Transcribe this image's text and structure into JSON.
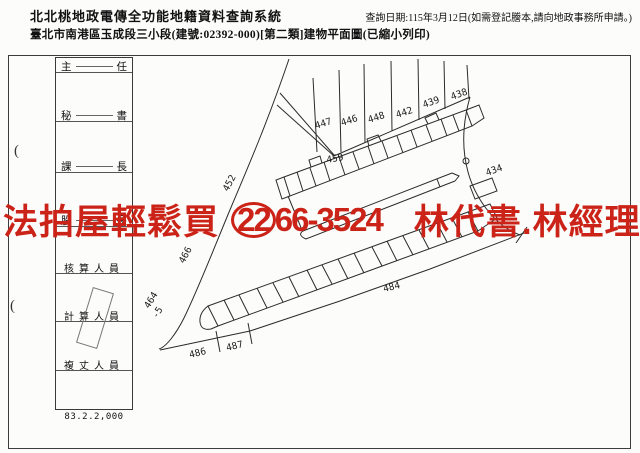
{
  "header": {
    "system_title": "北北桃地政電傳全功能地籍資料查詢系統",
    "subtitle": "臺北市南港區玉成段三小段(建號:02392-000)[第二類]建物平面圖(已縮小列印)",
    "query_date": "查詢日期:115年3月12日(如需登記謄本,請向地政事務所申請。)"
  },
  "watermark": {
    "left_text": "法拍屋輕鬆買",
    "phone_circled": "22",
    "phone_rest": "66-3524",
    "right_text": "林代書.林經理",
    "color": "#cb2318"
  },
  "signature_strip": {
    "rows": [
      {
        "left": "主",
        "right": "任"
      },
      {
        "left": "秘",
        "right": "書"
      },
      {
        "left": "課",
        "right": "長"
      },
      {
        "left": "股",
        "right": "長"
      },
      {
        "text": "核算人員"
      },
      {
        "text": "計算人員"
      },
      {
        "text": "複丈人員"
      }
    ],
    "form_number": "83.2.2,000",
    "margin_mark": "("
  },
  "map": {
    "line_color": "#2b2b2b",
    "labels": [
      "447",
      "446",
      "448",
      "442",
      "439",
      "438",
      "459",
      "452",
      "466",
      "434",
      "464",
      "-5",
      "486",
      "487",
      "484"
    ]
  }
}
